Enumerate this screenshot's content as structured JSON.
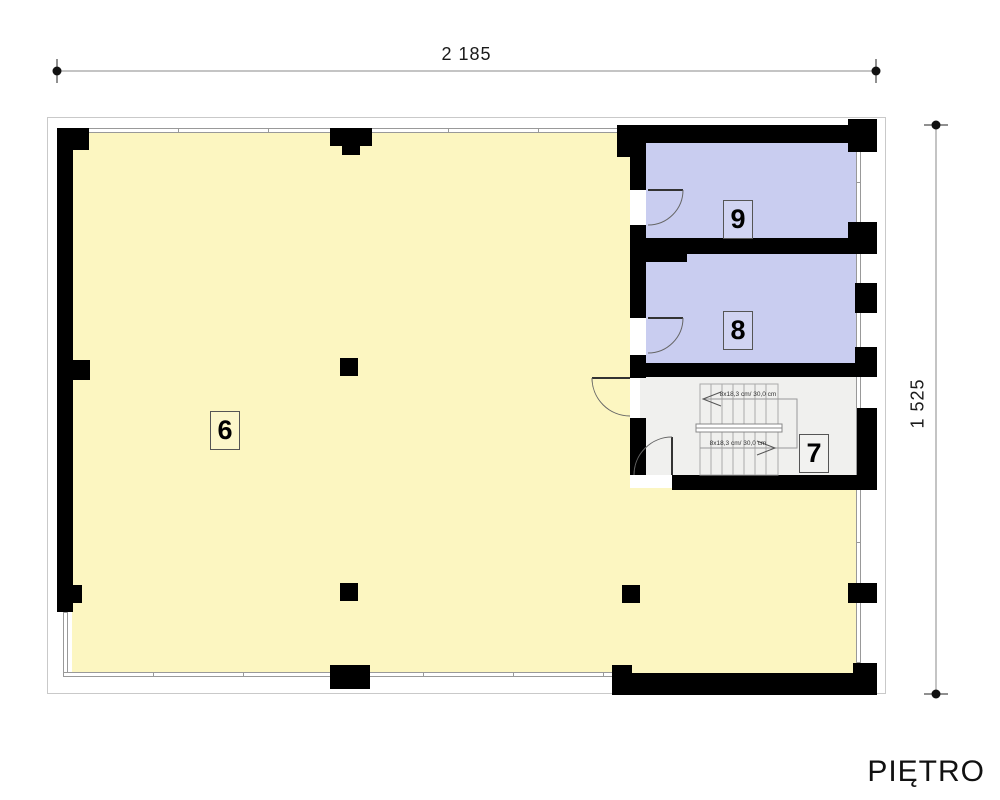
{
  "title": "PIĘTRO",
  "dimensions": {
    "width": "2 185",
    "height": "1 525"
  },
  "rooms": [
    {
      "label": "6"
    },
    {
      "label": "7"
    },
    {
      "label": "8"
    },
    {
      "label": "9"
    }
  ],
  "stairs": {
    "upper_flight_label": "8x18,3 cm/ 30,0 cm",
    "lower_flight_label": "8x18,3 cm/ 30,0 cm"
  },
  "colors": {
    "room_6_fill": "#FCF6C1",
    "room_8_9_fill": "#C9CDF0",
    "staircase_fill": "#F0F0EE",
    "wall": "#000000",
    "thin_line": "#999999",
    "dimension_line": "#888888"
  }
}
